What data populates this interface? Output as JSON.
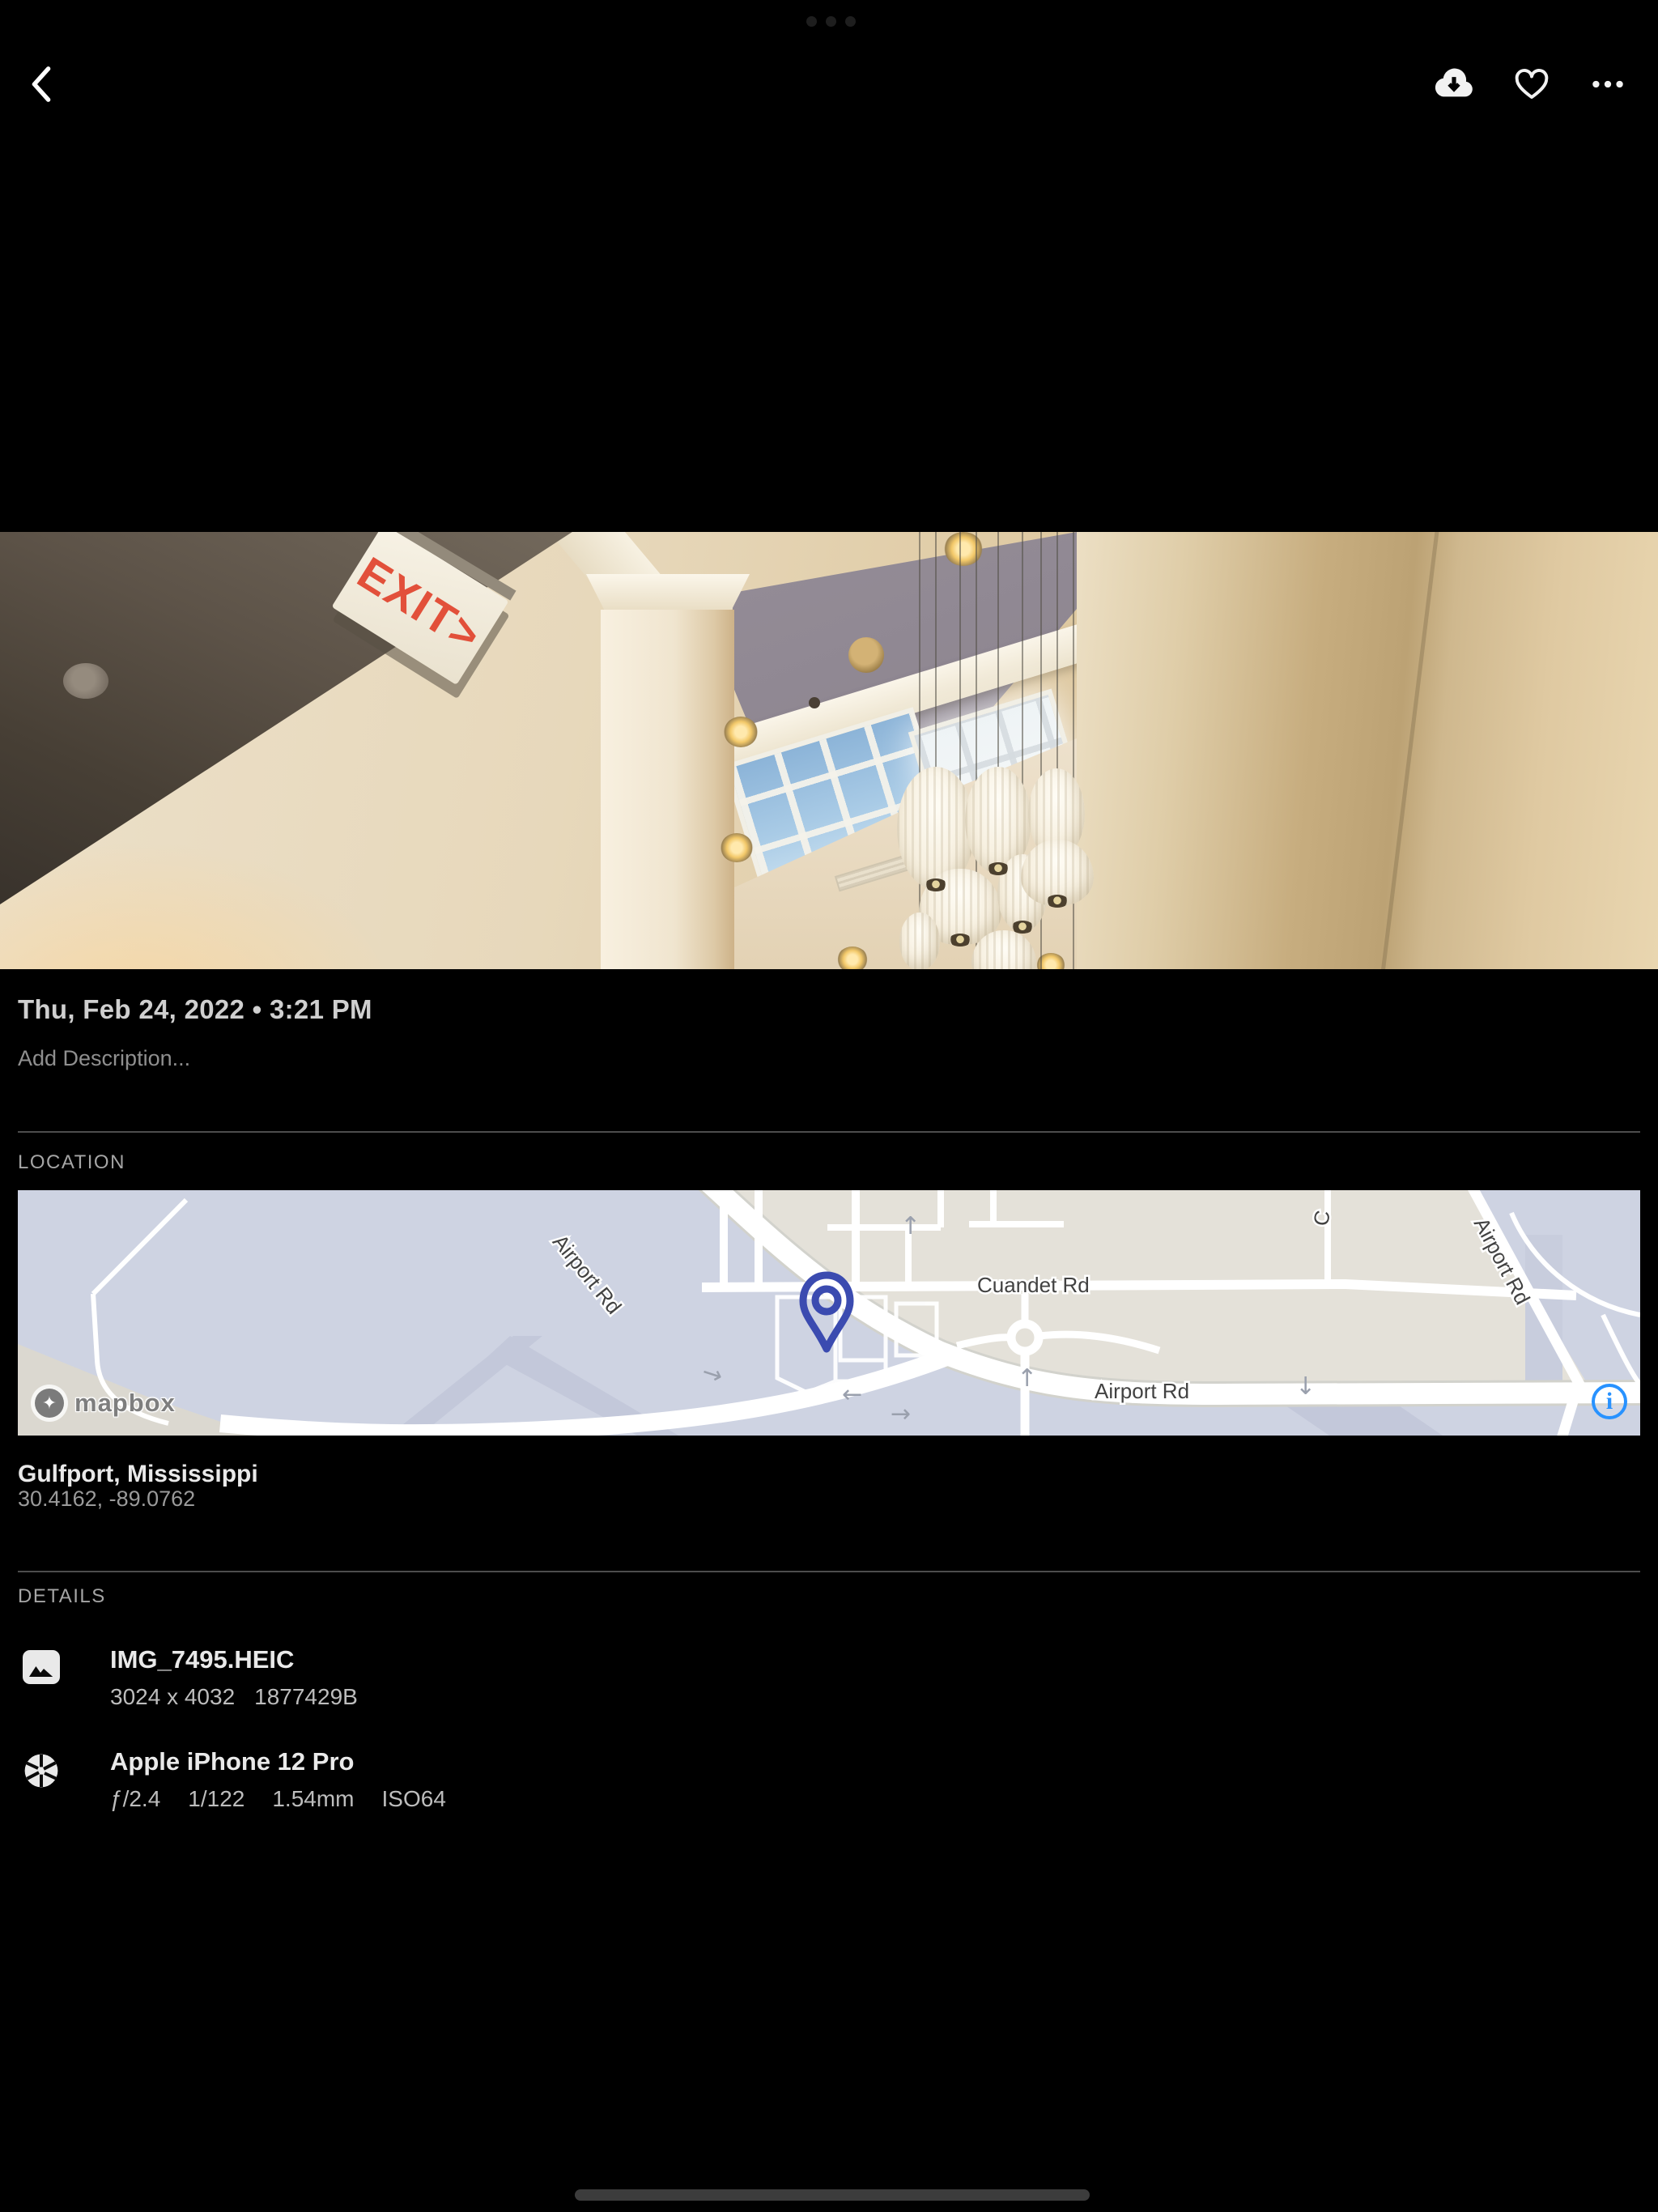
{
  "header": {
    "icons": {
      "back": "chevron-left",
      "download": "cloud-arrow-down",
      "favorite": "heart-outline",
      "more": "ellipsis-horizontal"
    }
  },
  "photo": {
    "exit_sign": "EXIT>"
  },
  "meta": {
    "date_line": "Thu, Feb 24, 2022 • 3:21 PM",
    "description_placeholder": "Add Description..."
  },
  "location": {
    "heading": "LOCATION",
    "place": "Gulfport, Mississippi",
    "coordinates": "30.4162, -89.0762",
    "map": {
      "labels": {
        "airport_rd_nw": "Airport Rd",
        "cuandet_rd": "Cuandet Rd",
        "airport_rd_s": "Airport Rd",
        "airport_rd_ne": "Airport Rd",
        "partial_street": "C"
      },
      "arrows": {
        "left": "←",
        "right": "→",
        "up": "↑",
        "down": "↓"
      },
      "attribution": "mapbox",
      "info_icon": "i"
    }
  },
  "details": {
    "heading": "DETAILS",
    "file": {
      "name": "IMG_7495.HEIC",
      "dimensions": "3024 x 4032",
      "size": "1877429B"
    },
    "camera": {
      "name": "Apple iPhone 12 Pro",
      "aperture": "ƒ/2.4",
      "shutter": "1/122",
      "focal": "1.54mm",
      "iso": "ISO64"
    }
  },
  "colors": {
    "accent_blue": "#2892ff",
    "pin_blue": "#3b4bb0",
    "map_land": "#e4e1d9",
    "map_water": "#ced3e2"
  }
}
